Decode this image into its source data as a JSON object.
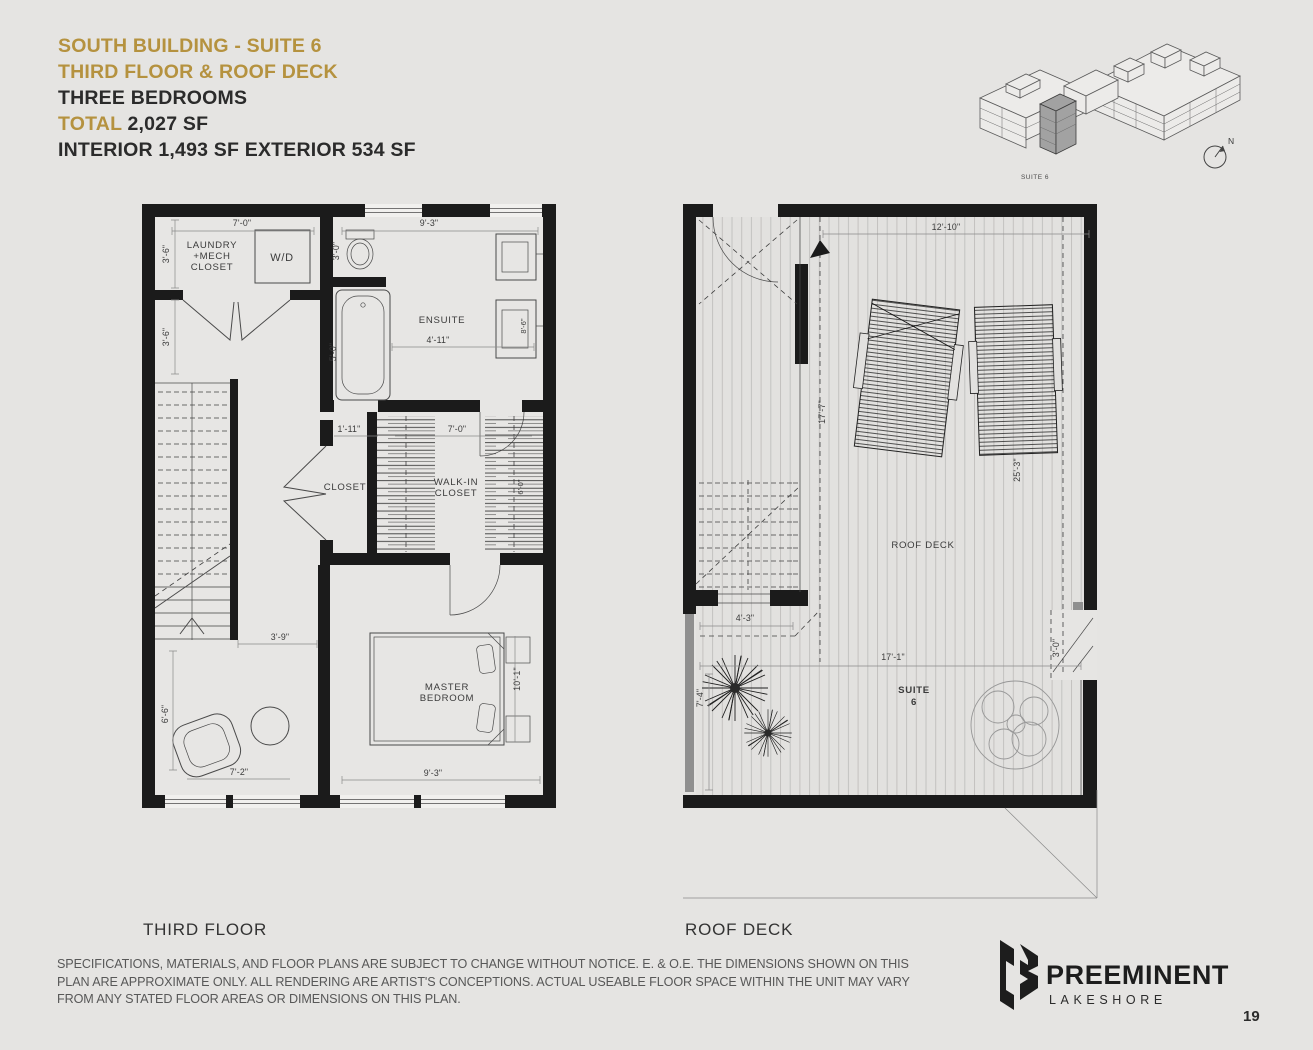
{
  "colors": {
    "accent": "#b5923f",
    "wall": "#1b1b1b",
    "background": "#e5e4e2"
  },
  "header": {
    "title": "SOUTH BUILDING - SUITE 6",
    "subtitle": "THIRD FLOOR & ROOF DECK",
    "bedrooms": "THREE BEDROOMS",
    "total_label": "TOTAL",
    "total_value": " 2,027 SF",
    "area_detail": "INTERIOR 1,493 SF EXTERIOR 534 SF"
  },
  "locator": {
    "suite_label": "SUITE 6",
    "compass": "N"
  },
  "third_floor": {
    "caption": "THIRD FLOOR",
    "labels": {
      "laundry1": "LAUNDRY",
      "laundry2": "+MECH",
      "laundry3": "CLOSET",
      "wd": "W/D",
      "ensuite": "ENSUITE",
      "closet": "CLOSET",
      "walkin1": "WALK-IN",
      "walkin2": "CLOSET",
      "master1": "MASTER",
      "master2": "BEDROOM"
    },
    "dims": {
      "d7_0": "7'-0\"",
      "d3_6a": "3'-6\"",
      "d3_6b": "3'-6\"",
      "d3_0": "3'-0\"",
      "d9_3": "9'-3\"",
      "d5_0": "5'-0\"",
      "d4_11": "4'-11\"",
      "d8_6": "8'-6\"",
      "d1_11": "1'-11\"",
      "d7_0b": "7'-0\"",
      "d6_0": "6'-0\"",
      "d3_9": "3'-9\"",
      "d6_6": "6'-6\"",
      "d7_2": "7'-2\"",
      "d10_1": "10'-1\"",
      "d9_3b": "9'-3\""
    }
  },
  "roof_deck": {
    "caption": "ROOF DECK",
    "label": "ROOF DECK",
    "suite1": "SUITE",
    "suite2": "6",
    "dims": {
      "d12_10": "12'-10\"",
      "d17_7": "17'-7\"",
      "d25_3": "25'-3\"",
      "d4_3": "4'-3\"",
      "d17_1": "17'-1\"",
      "d3_0": "3'-0\"",
      "d7_4": "7'-4\""
    }
  },
  "footer": {
    "disclaimer1": "SPECIFICATIONS, MATERIALS, AND FLOOR PLANS ARE SUBJECT TO CHANGE WITHOUT NOTICE. E. & O.E. THE DIMENSIONS SHOWN ON THIS",
    "disclaimer2": "PLAN ARE APPROXIMATE ONLY. ALL RENDERING ARE ARTIST'S CONCEPTIONS. ACTUAL USEABLE FLOOR SPACE WITHIN THE UNIT MAY VARY",
    "disclaimer3": "FROM ANY STATED FLOOR AREAS OR DIMENSIONS ON THIS PLAN.",
    "brand": "PREEMINENT",
    "brand_sub": "LAKESHORE",
    "page_number": "19"
  }
}
